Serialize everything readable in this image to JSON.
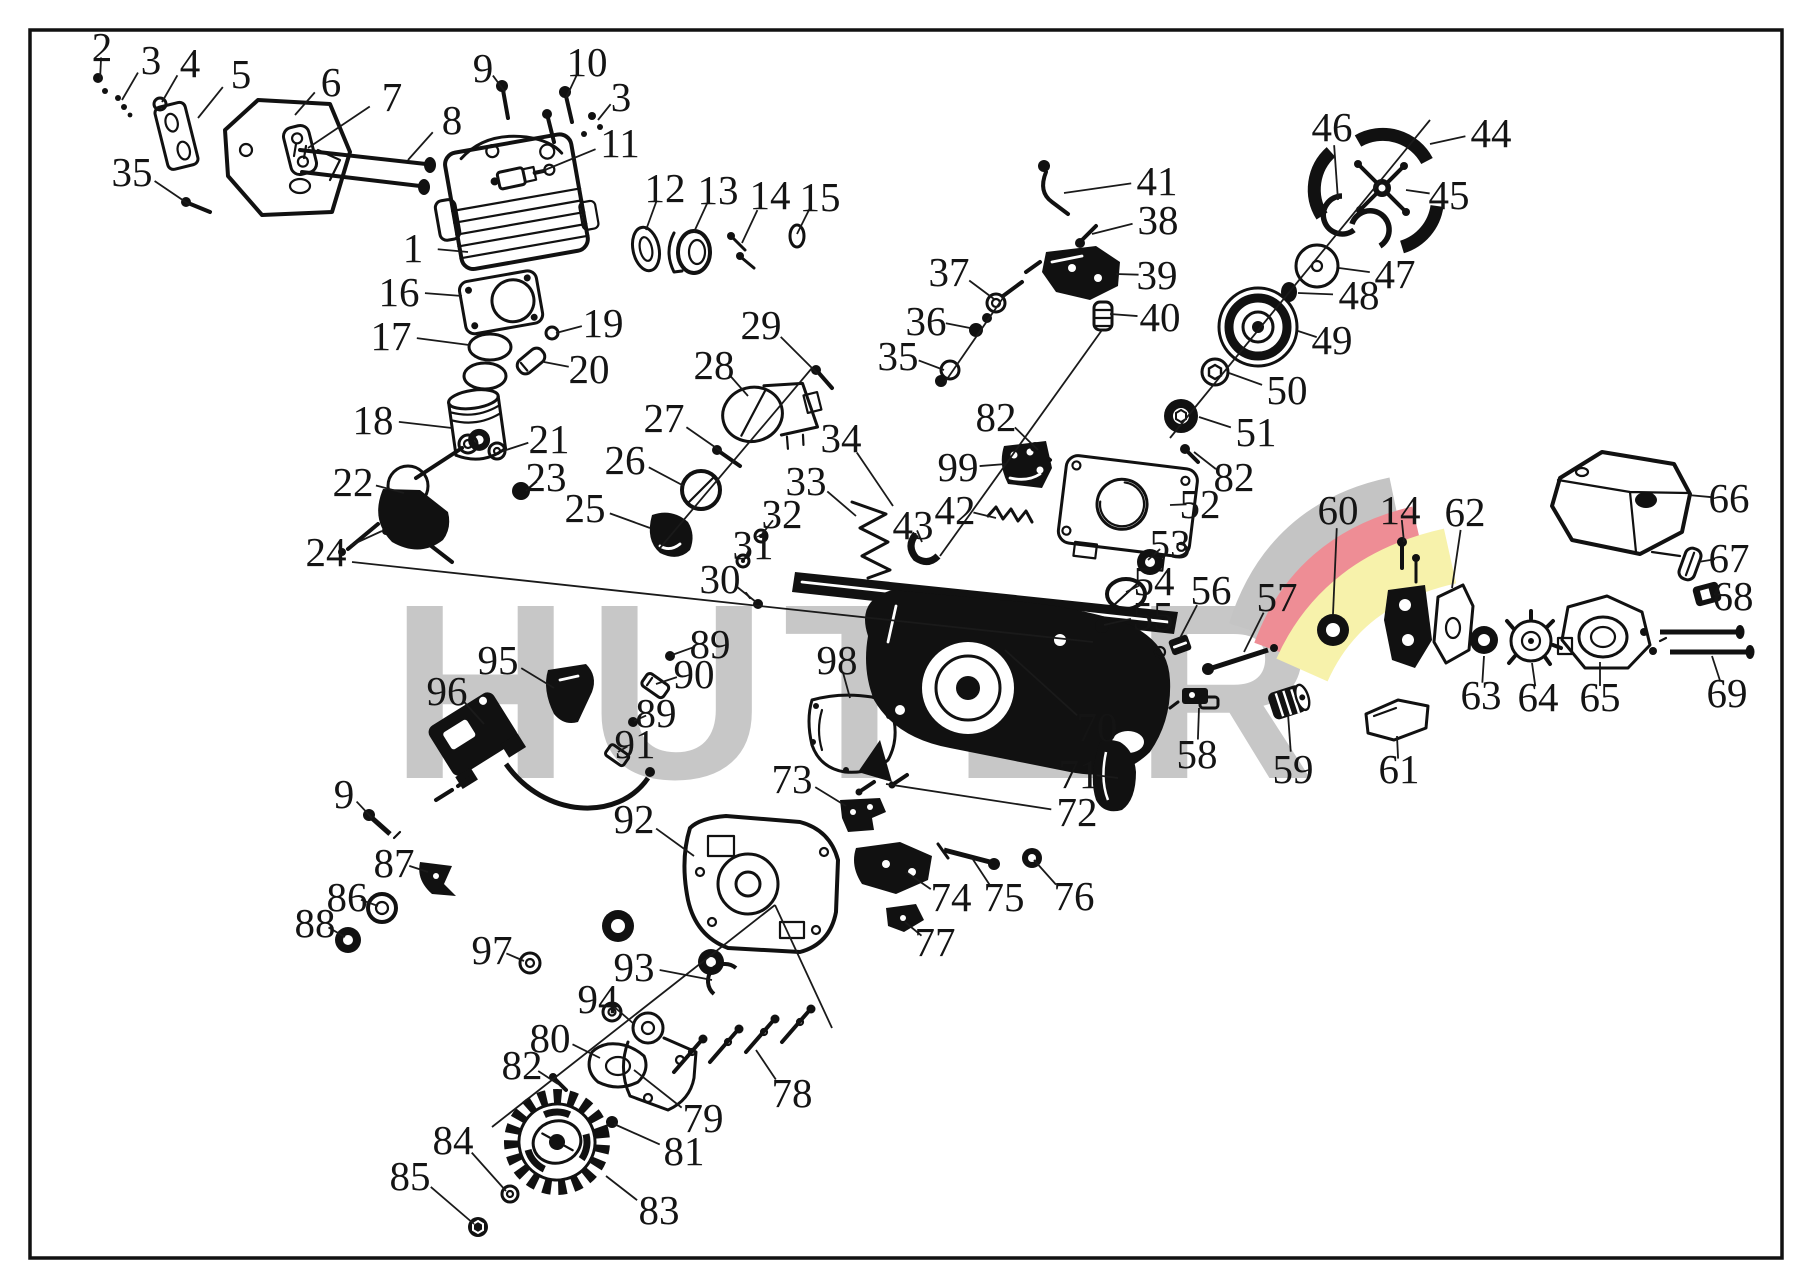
{
  "watermark": {
    "text": "HUTER"
  },
  "colors": {
    "line": "#141414",
    "watermark_gray": "#c7c7c7",
    "logo_gray": "#c4c4c4",
    "logo_red": "#ee8d95",
    "logo_yellow": "#f7f2ab",
    "background": "#ffffff"
  },
  "diagram": {
    "labels": [
      {
        "n": "2",
        "x": 102,
        "y": 47,
        "tx": 100,
        "ty": 80
      },
      {
        "n": "3",
        "x": 151,
        "y": 60,
        "tx": 122,
        "ty": 100
      },
      {
        "n": "4",
        "x": 190,
        "y": 63,
        "tx": 162,
        "ty": 102
      },
      {
        "n": "5",
        "x": 241,
        "y": 74,
        "tx": 198,
        "ty": 118
      },
      {
        "n": "6",
        "x": 331,
        "y": 82,
        "tx": 295,
        "ty": 115
      },
      {
        "n": "7",
        "x": 392,
        "y": 97,
        "tx": 308,
        "ty": 148
      },
      {
        "n": "8",
        "x": 452,
        "y": 120,
        "tx": 408,
        "ty": 160
      },
      {
        "n": "9",
        "x": 483,
        "y": 68,
        "tx": 505,
        "ty": 92
      },
      {
        "n": "10",
        "x": 587,
        "y": 62,
        "tx": 566,
        "ty": 98
      },
      {
        "n": "3",
        "x": 621,
        "y": 97,
        "tx": 598,
        "ty": 120
      },
      {
        "n": "35",
        "x": 132,
        "y": 172,
        "tx": 190,
        "ty": 205
      },
      {
        "n": "11",
        "x": 620,
        "y": 143,
        "tx": 540,
        "ty": 172
      },
      {
        "n": "12",
        "x": 665,
        "y": 188,
        "tx": 646,
        "ty": 230
      },
      {
        "n": "13",
        "x": 718,
        "y": 190,
        "tx": 694,
        "ty": 232
      },
      {
        "n": "14",
        "x": 770,
        "y": 195,
        "tx": 742,
        "ty": 243
      },
      {
        "n": "15",
        "x": 820,
        "y": 197,
        "tx": 797,
        "ty": 234
      },
      {
        "n": "1",
        "x": 413,
        "y": 248,
        "tx": 468,
        "ty": 252
      },
      {
        "n": "16",
        "x": 399,
        "y": 292,
        "tx": 462,
        "ty": 296
      },
      {
        "n": "17",
        "x": 391,
        "y": 336,
        "tx": 469,
        "ty": 345
      },
      {
        "n": "19",
        "x": 603,
        "y": 323,
        "tx": 556,
        "ty": 333
      },
      {
        "n": "20",
        "x": 589,
        "y": 369,
        "tx": 544,
        "ty": 362
      },
      {
        "n": "18",
        "x": 373,
        "y": 420,
        "tx": 452,
        "ty": 428
      },
      {
        "n": "21",
        "x": 549,
        "y": 439,
        "tx": 503,
        "ty": 451
      },
      {
        "n": "23",
        "x": 546,
        "y": 477,
        "tx": 526,
        "ty": 491
      },
      {
        "n": "22",
        "x": 353,
        "y": 482,
        "tx": 404,
        "ty": 493
      },
      {
        "n": "24",
        "x": 326,
        "y": 552,
        "tx": 382,
        "ty": 531
      },
      {
        "n": "25",
        "x": 585,
        "y": 508,
        "tx": 650,
        "ty": 528
      },
      {
        "n": "26",
        "x": 625,
        "y": 460,
        "tx": 684,
        "ty": 486
      },
      {
        "n": "27",
        "x": 664,
        "y": 418,
        "tx": 722,
        "ty": 452
      },
      {
        "n": "28",
        "x": 714,
        "y": 365,
        "tx": 748,
        "ty": 396
      },
      {
        "n": "29",
        "x": 761,
        "y": 325,
        "tx": 818,
        "ty": 374
      },
      {
        "n": "34",
        "x": 841,
        "y": 438,
        "tx": 893,
        "ty": 506
      },
      {
        "n": "33",
        "x": 806,
        "y": 481,
        "tx": 856,
        "ty": 516
      },
      {
        "n": "32",
        "x": 782,
        "y": 514,
        "tx": 762,
        "ty": 534
      },
      {
        "n": "31",
        "x": 753,
        "y": 545,
        "tx": 744,
        "ty": 560
      },
      {
        "n": "30",
        "x": 720,
        "y": 579,
        "tx": 756,
        "ty": 602
      },
      {
        "n": "89",
        "x": 710,
        "y": 644,
        "tx": 672,
        "ty": 655
      },
      {
        "n": "90",
        "x": 694,
        "y": 674,
        "tx": 656,
        "ty": 684
      },
      {
        "n": "89",
        "x": 656,
        "y": 713,
        "tx": 634,
        "ty": 721
      },
      {
        "n": "91",
        "x": 635,
        "y": 744,
        "tx": 618,
        "ty": 752
      },
      {
        "n": "98",
        "x": 837,
        "y": 660,
        "tx": 850,
        "ty": 698
      },
      {
        "n": "73",
        "x": 792,
        "y": 779,
        "tx": 846,
        "ty": 806
      },
      {
        "n": "92",
        "x": 634,
        "y": 819,
        "tx": 694,
        "ty": 856
      },
      {
        "n": "95",
        "x": 498,
        "y": 660,
        "tx": 554,
        "ty": 688
      },
      {
        "n": "96",
        "x": 447,
        "y": 691,
        "tx": 484,
        "ty": 724
      },
      {
        "n": "9",
        "x": 344,
        "y": 794,
        "tx": 372,
        "ty": 818
      },
      {
        "n": "87",
        "x": 394,
        "y": 863,
        "tx": 428,
        "ty": 872
      },
      {
        "n": "86",
        "x": 347,
        "y": 897,
        "tx": 378,
        "ty": 906
      },
      {
        "n": "88",
        "x": 315,
        "y": 923,
        "tx": 345,
        "ty": 937
      },
      {
        "n": "97",
        "x": 492,
        "y": 950,
        "tx": 524,
        "ty": 961
      },
      {
        "n": "93",
        "x": 634,
        "y": 967,
        "tx": 712,
        "ty": 980
      },
      {
        "n": "94",
        "x": 598,
        "y": 999,
        "tx": 634,
        "ty": 1024
      },
      {
        "n": "80",
        "x": 550,
        "y": 1038,
        "tx": 600,
        "ty": 1058
      },
      {
        "n": "82",
        "x": 522,
        "y": 1065,
        "tx": 558,
        "ty": 1084
      },
      {
        "n": "84",
        "x": 453,
        "y": 1140,
        "tx": 506,
        "ty": 1191
      },
      {
        "n": "85",
        "x": 410,
        "y": 1176,
        "tx": 474,
        "ty": 1224
      },
      {
        "n": "83",
        "x": 659,
        "y": 1210,
        "tx": 606,
        "ty": 1176
      },
      {
        "n": "79",
        "x": 703,
        "y": 1118,
        "tx": 634,
        "ty": 1070
      },
      {
        "n": "81",
        "x": 684,
        "y": 1151,
        "tx": 614,
        "ty": 1124
      },
      {
        "n": "78",
        "x": 792,
        "y": 1093,
        "tx": 756,
        "ty": 1050
      },
      {
        "n": "74",
        "x": 951,
        "y": 897,
        "tx": 906,
        "ty": 872
      },
      {
        "n": "75",
        "x": 1004,
        "y": 897,
        "tx": 972,
        "ty": 858
      },
      {
        "n": "76",
        "x": 1074,
        "y": 896,
        "tx": 1034,
        "ty": 860
      },
      {
        "n": "77",
        "x": 935,
        "y": 942,
        "tx": 905,
        "ty": 922
      },
      {
        "n": "70",
        "x": 1097,
        "y": 727,
        "tx": 1005,
        "ty": 650
      },
      {
        "n": "71",
        "x": 1079,
        "y": 774,
        "tx": 1118,
        "ty": 778
      },
      {
        "n": "72",
        "x": 1077,
        "y": 812,
        "tx": 886,
        "ty": 784
      },
      {
        "n": "58",
        "x": 1197,
        "y": 754,
        "tx": 1199,
        "ty": 708
      },
      {
        "n": "59",
        "x": 1293,
        "y": 769,
        "tx": 1288,
        "ty": 714
      },
      {
        "n": "61",
        "x": 1399,
        "y": 769,
        "tx": 1397,
        "ty": 736
      },
      {
        "n": "41",
        "x": 1157,
        "y": 181,
        "tx": 1064,
        "ty": 193
      },
      {
        "n": "38",
        "x": 1158,
        "y": 220,
        "tx": 1092,
        "ty": 234
      },
      {
        "n": "39",
        "x": 1157,
        "y": 275,
        "tx": 1116,
        "ty": 274
      },
      {
        "n": "40",
        "x": 1160,
        "y": 317,
        "tx": 1110,
        "ty": 314
      },
      {
        "n": "37",
        "x": 949,
        "y": 272,
        "tx": 994,
        "ty": 299
      },
      {
        "n": "36",
        "x": 926,
        "y": 321,
        "tx": 970,
        "ty": 328
      },
      {
        "n": "35",
        "x": 898,
        "y": 356,
        "tx": 944,
        "ty": 370
      },
      {
        "n": "82",
        "x": 996,
        "y": 417,
        "tx": 1038,
        "ty": 450
      },
      {
        "n": "99",
        "x": 958,
        "y": 467,
        "tx": 1006,
        "ty": 464
      },
      {
        "n": "42",
        "x": 955,
        "y": 510,
        "tx": 996,
        "ty": 518
      },
      {
        "n": "43",
        "x": 913,
        "y": 525,
        "tx": 922,
        "ty": 542
      },
      {
        "n": "46",
        "x": 1332,
        "y": 127,
        "tx": 1338,
        "ty": 200
      },
      {
        "n": "44",
        "x": 1491,
        "y": 133,
        "tx": 1430,
        "ty": 144
      },
      {
        "n": "45",
        "x": 1449,
        "y": 195,
        "tx": 1406,
        "ty": 190
      },
      {
        "n": "47",
        "x": 1395,
        "y": 274,
        "tx": 1339,
        "ty": 268
      },
      {
        "n": "48",
        "x": 1359,
        "y": 295,
        "tx": 1298,
        "ty": 293
      },
      {
        "n": "49",
        "x": 1332,
        "y": 340,
        "tx": 1298,
        "ty": 331
      },
      {
        "n": "50",
        "x": 1287,
        "y": 390,
        "tx": 1229,
        "ty": 373
      },
      {
        "n": "51",
        "x": 1256,
        "y": 432,
        "tx": 1199,
        "ty": 417
      },
      {
        "n": "82",
        "x": 1234,
        "y": 477,
        "tx": 1194,
        "ty": 452
      },
      {
        "n": "52",
        "x": 1200,
        "y": 504,
        "tx": 1170,
        "ty": 505
      },
      {
        "n": "53",
        "x": 1170,
        "y": 544,
        "tx": 1148,
        "ty": 560
      },
      {
        "n": "54",
        "x": 1154,
        "y": 581,
        "tx": 1126,
        "ty": 592
      },
      {
        "n": "55",
        "x": 1153,
        "y": 616,
        "tx": 1104,
        "ty": 625
      },
      {
        "n": "56",
        "x": 1211,
        "y": 590,
        "tx": 1180,
        "ty": 638
      },
      {
        "n": "57",
        "x": 1277,
        "y": 597,
        "tx": 1244,
        "ty": 652
      },
      {
        "n": "60",
        "x": 1338,
        "y": 510,
        "tx": 1333,
        "ty": 614
      },
      {
        "n": "14",
        "x": 1400,
        "y": 510,
        "tx": 1404,
        "ty": 542
      },
      {
        "n": "62",
        "x": 1465,
        "y": 512,
        "tx": 1452,
        "ty": 588
      },
      {
        "n": "66",
        "x": 1729,
        "y": 498,
        "tx": 1688,
        "ty": 495
      },
      {
        "n": "67",
        "x": 1729,
        "y": 558,
        "tx": 1698,
        "ty": 562
      },
      {
        "n": "68",
        "x": 1733,
        "y": 596,
        "tx": 1714,
        "ty": 594
      },
      {
        "n": "69",
        "x": 1727,
        "y": 693,
        "tx": 1712,
        "ty": 656
      },
      {
        "n": "63",
        "x": 1481,
        "y": 695,
        "tx": 1484,
        "ty": 656
      },
      {
        "n": "64",
        "x": 1538,
        "y": 697,
        "tx": 1532,
        "ty": 663
      },
      {
        "n": "65",
        "x": 1600,
        "y": 697,
        "tx": 1600,
        "ty": 662
      }
    ],
    "construction_lines": [
      [
        352,
        562,
        1093,
        642
      ],
      [
        660,
        548,
        812,
        368
      ],
      [
        1005,
        295,
        945,
        382
      ],
      [
        1102,
        330,
        940,
        556
      ],
      [
        1430,
        120,
        1170,
        438
      ],
      [
        775,
        905,
        492,
        1127
      ],
      [
        775,
        905,
        832,
        1028
      ]
    ]
  }
}
